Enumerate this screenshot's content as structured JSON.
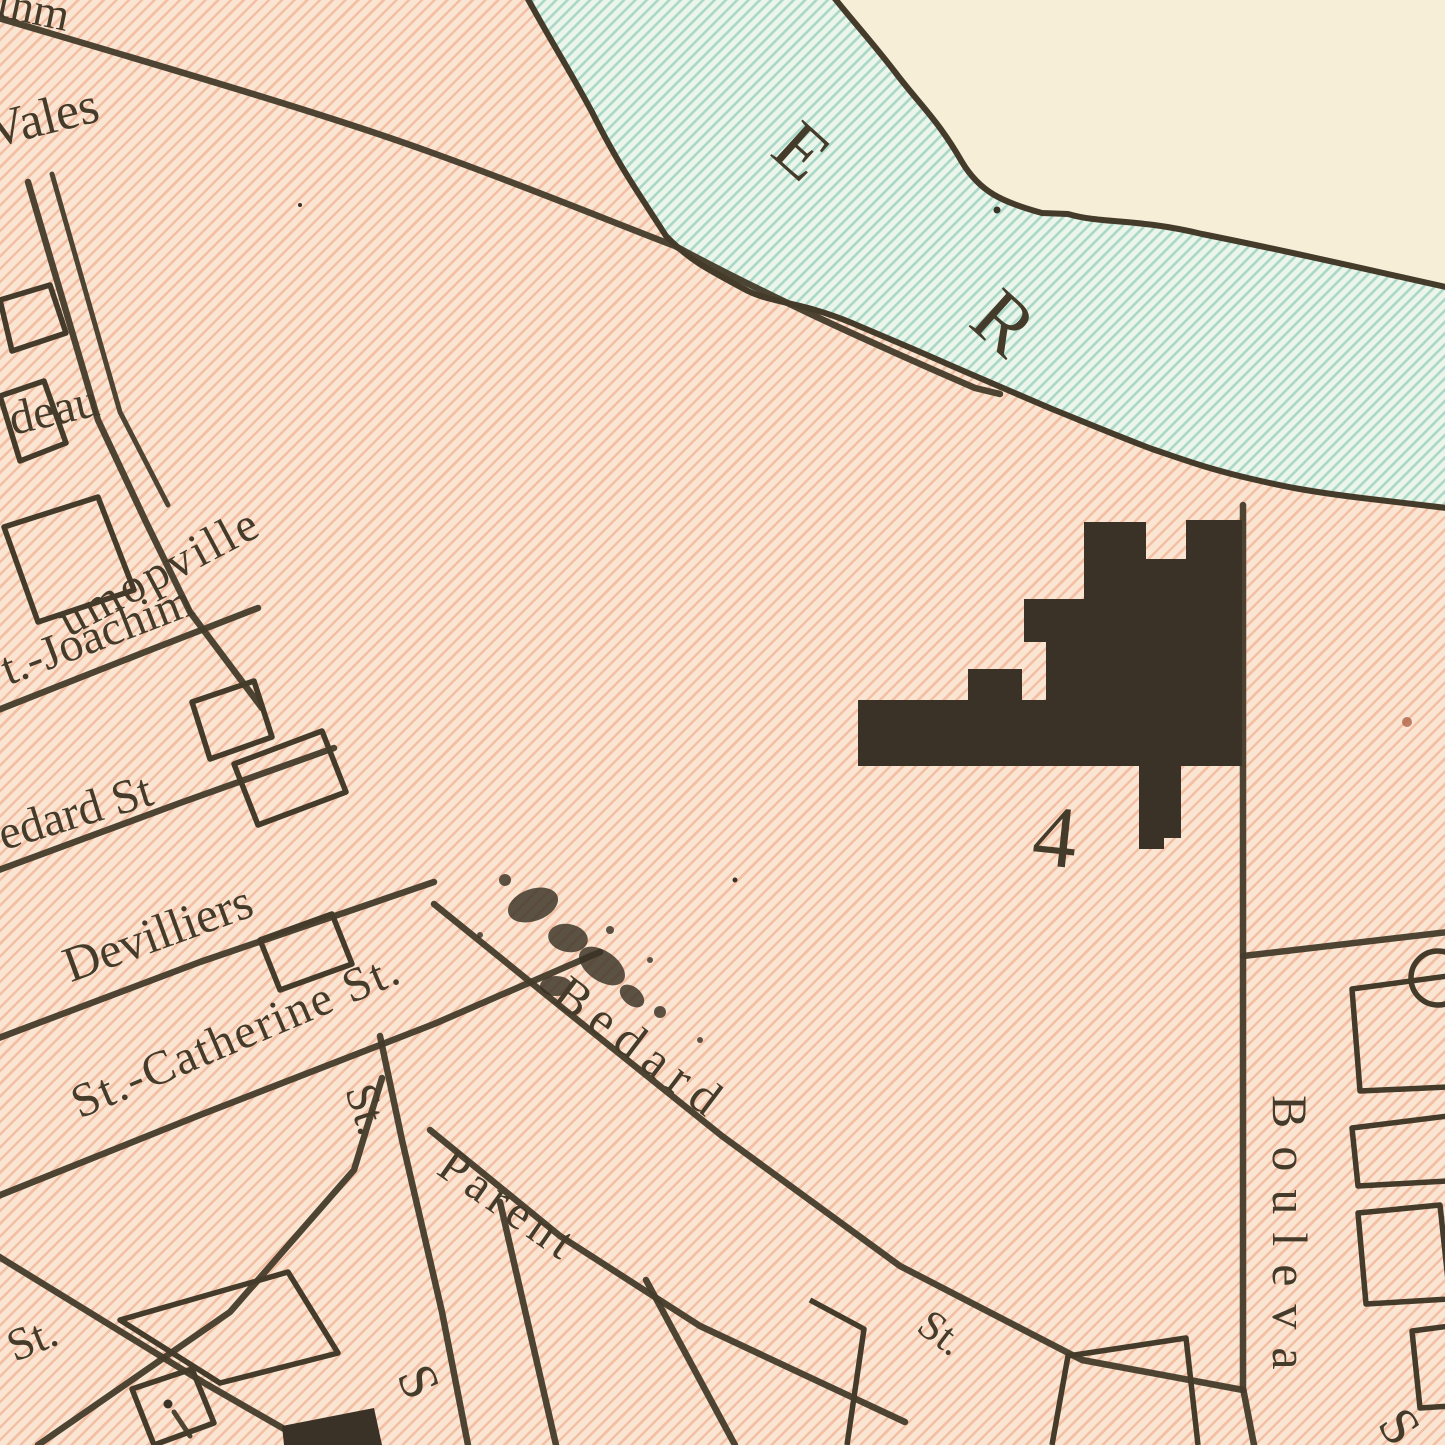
{
  "map": {
    "description": "Vintage engraved city map detail: pink hatched city blocks beside a hatched river, black building footprint numbered 4",
    "palette": {
      "land_base": "#fae5d2",
      "land_stripe": "rgba(238,160,127,0.55)",
      "river_base": "#ecf5e9",
      "river_stripe": "#a9d8c9",
      "far_shore": "#f6eed6",
      "ink": "#453b2a",
      "ink2": "#3a3226"
    },
    "river": {
      "letters_visible": "E R",
      "note": "letters of river name set along the stream"
    },
    "building_number": "4",
    "labels": [
      {
        "name": "street-label-fragment-top",
        "text": "thm",
        "x": 4,
        "y": -22,
        "rot": 12,
        "size": 46
      },
      {
        "name": "street-label-vales",
        "text": "Vales",
        "x": -18,
        "y": 106,
        "rot": -14,
        "size": 52
      },
      {
        "name": "street-label-deau",
        "text": "deau",
        "x": 4,
        "y": 396,
        "rot": -13,
        "size": 48
      },
      {
        "name": "street-label-umopville",
        "text": "umopville",
        "x": 50,
        "y": 602,
        "rot": -28,
        "size": 48,
        "ls": 3
      },
      {
        "name": "street-label-st-joachim",
        "text": "t.-Joachim",
        "x": -6,
        "y": 648,
        "rot": -21,
        "size": 48
      },
      {
        "name": "street-label-bedard-west",
        "text": "edard St",
        "x": -8,
        "y": 812,
        "rot": -17,
        "size": 48
      },
      {
        "name": "street-label-devilliers",
        "text": "Devilliers",
        "x": 56,
        "y": 942,
        "rot": -20,
        "size": 50
      },
      {
        "name": "street-label-st-catherine",
        "text": "St.-Catherine St.",
        "x": 64,
        "y": 1082,
        "rot": -23,
        "size": 48,
        "ls": 2
      },
      {
        "name": "street-label-bedard",
        "text": "Bedard",
        "x": 576,
        "y": 966,
        "rot": 37,
        "size": 50,
        "ls": 10
      },
      {
        "name": "street-label-bedard-st-suffix",
        "text": "St.",
        "x": 936,
        "y": 1302,
        "rot": 37,
        "size": 42
      },
      {
        "name": "street-label-parent",
        "text": "Parent",
        "x": 458,
        "y": 1140,
        "rot": 35,
        "size": 48,
        "ls": 6
      },
      {
        "name": "street-label-st-vertical",
        "text": "St.",
        "x": 382,
        "y": 1078,
        "rot": 72,
        "size": 46
      },
      {
        "name": "street-label-s-bottom",
        "text": "S",
        "x": 438,
        "y": 1356,
        "rot": 65,
        "size": 54
      },
      {
        "name": "street-label-st-bottomleft",
        "text": "St.",
        "x": 0,
        "y": 1326,
        "rot": -22,
        "size": 46
      },
      {
        "name": "street-label-boulevard",
        "text": "Bouleva",
        "x": 1316,
        "y": 1095,
        "rot": 90,
        "size": 50,
        "ls": 18
      },
      {
        "name": "river-letter-e",
        "text": "E",
        "x": 810,
        "y": 108,
        "rot": 42,
        "size": 74
      },
      {
        "name": "river-letter-r",
        "text": "R",
        "x": 1012,
        "y": 274,
        "rot": 42,
        "size": 80
      },
      {
        "name": "building-number-label",
        "text": "4",
        "x": 1038,
        "y": 790,
        "rot": 6,
        "size": 88
      },
      {
        "name": "street-label-s-bottomright",
        "text": "S",
        "x": 1414,
        "y": 1398,
        "rot": 55,
        "size": 54
      }
    ]
  }
}
